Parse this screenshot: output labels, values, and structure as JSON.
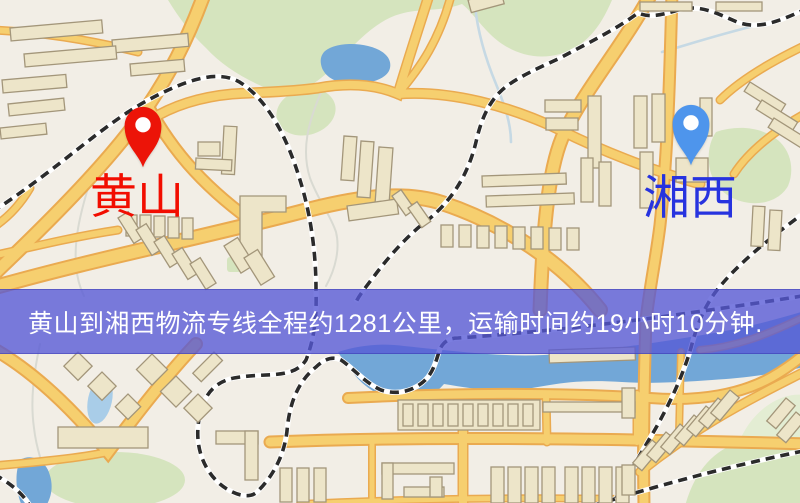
{
  "page": {
    "width_px": 800,
    "height_px": 503,
    "kind": "logistics-route-map-screenshot"
  },
  "banner": {
    "text": "黄山到湘西物流专线全程约1281公里，运输时间约19小时10分钟."
  },
  "route": {
    "origin": "黄山",
    "destination": "湘西",
    "distance_text": "约1281公里",
    "duration_text": "约19小时10分钟"
  },
  "markers": {
    "origin": {
      "label": "黄山",
      "icon": "map-pin-icon"
    },
    "destination": {
      "label": "湘西",
      "icon": "map-pin-icon"
    }
  },
  "map": {
    "palette": {
      "bg": "#F2EEE6",
      "road_fill": "#F6CF6F",
      "road_casing": "#EAAA50",
      "bld_fill": "#EDE5C9",
      "bld_stroke": "#A3967A",
      "water": "#72A7D7",
      "water_light": "#A9CDE8",
      "park": "#D5E4BE",
      "park_light": "#E3EDD3",
      "rail_dark": "#2B2B2B",
      "rail_light": "#FFFFFF",
      "river": "#C6D9E4",
      "river_pale": "#D9DAD2",
      "banner_bg": "rgba(86,88,214,0.78)",
      "banner_text": "#FFFFFF",
      "origin_pin": "#EC1408",
      "origin_label": "#F20D00",
      "dest_pin": "#4E95EC",
      "dest_label": "#2733DF"
    }
  }
}
